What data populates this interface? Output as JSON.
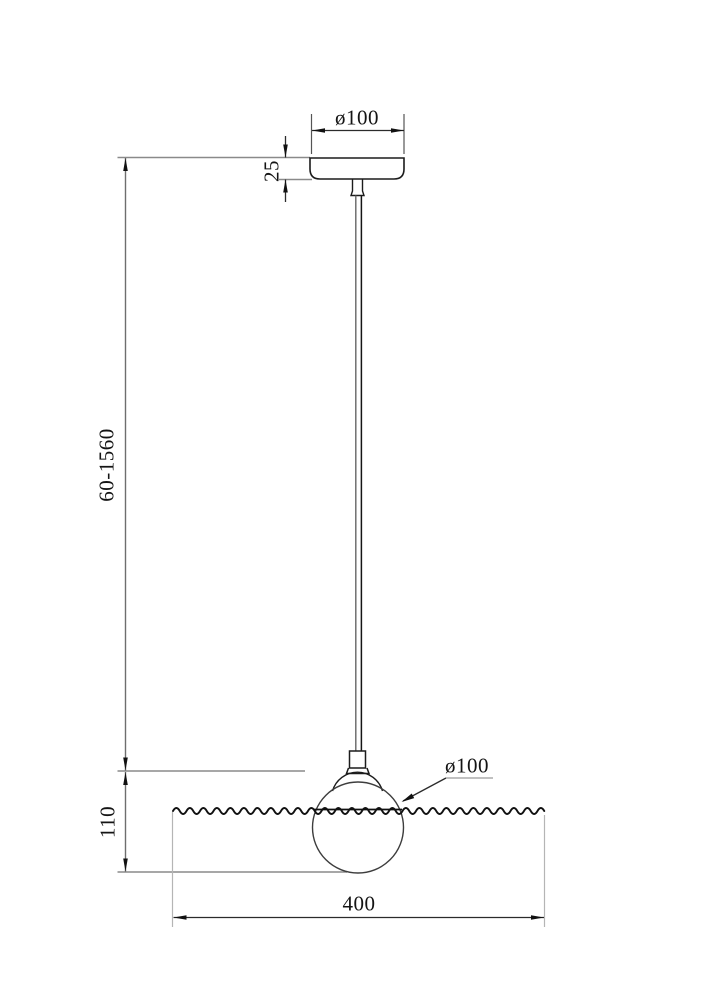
{
  "drawing": {
    "type": "technical-dimension-diagram",
    "subject": "pendant-lamp-elevation",
    "dimensions": {
      "canopy_diameter": "ø100",
      "canopy_height": "25",
      "suspension_length": "60-1560",
      "shade_diameter": "ø100",
      "shade_height": "110",
      "disc_width": "400"
    },
    "colors": {
      "background": "#ffffff",
      "object_line": "#1c1c1c",
      "dimension_line": "#2b2b2b",
      "extension_line": "#8a8a8a",
      "light_extension_line": "#b5b5b5",
      "text": "#141414"
    }
  }
}
